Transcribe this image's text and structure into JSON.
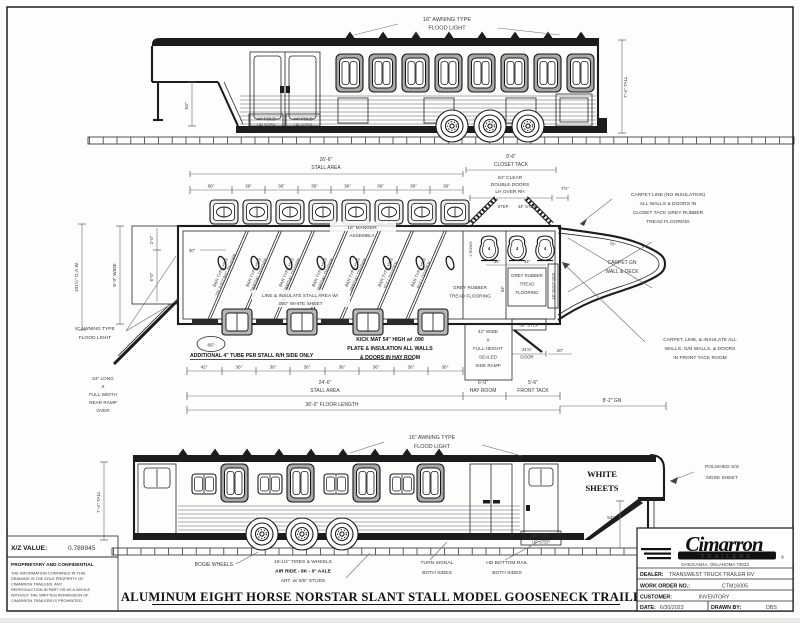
{
  "sheet": {
    "xz_label": "X/Z VALUE:",
    "xz_value": "0.788945",
    "confidential_title": "PROPRIETARY AND CONFIDENTIAL",
    "confidential_lines": [
      "THE INFORMATION CONTAINED IN THIS",
      "DRAWING IS THE SOLE PROPERTY OF",
      "CIMARRON TRAILERS.  ANY",
      "REPRODUCTION IN PART OR AS A WHOLE",
      "WITHOUT THE WRITTEN PERMISSION OF",
      "CIMARRON TRAILERS IS PROHIBITED."
    ],
    "main_title": "ALUMINUM EIGHT HORSE NORSTAR SLANT STALL MODEL GOOSENECK TRAILER"
  },
  "title_block": {
    "brand": "Cimarron",
    "brand_sub": "TRAILERS",
    "brand_reg": "®",
    "address": "CHICKASHA, OKLAHOMA 73023",
    "dealer_label": "DEALER:",
    "dealer_value": "TRANSWEST TRUCK TRAILER RV",
    "work_order_label": "WORK ORDER NO.:",
    "work_order_value": "CTM16005",
    "customer_label": "CUSTOMER:",
    "customer_value": "INVENTORY",
    "date_label": "DATE:",
    "date_value": "6/30/2023",
    "drawn_label": "DRAWN BY:",
    "drawn_value": "DBS"
  },
  "top_view": {
    "flood_light": [
      "16\" AWNING TYPE",
      "FLOOD LIGHT"
    ],
    "height": "7'-4\" TALL",
    "gn_drop": "53\"",
    "fold_step": [
      "44\" FOLD",
      "UP STEP"
    ]
  },
  "plan": {
    "stall_area_top": {
      "dim": "26'-6\"",
      "label": "STALL AREA"
    },
    "closet_tack": {
      "dim": "9'-6\"",
      "label": "CLOSET TACK"
    },
    "top_dims": [
      "66\"",
      "36\"",
      "36\"",
      "36\"",
      "36\"",
      "36\"",
      "36\"",
      "36\""
    ],
    "clear_doors": [
      "84\" CLEAR",
      "DOUBLE DOORS",
      "LH OVER RH"
    ],
    "dim_7_half": "7½\"",
    "manger": [
      "18\" MANGER",
      "ASSEMBLY"
    ],
    "oaw": "101½\" O.A.W.",
    "wide": "8'-0\" WIDE",
    "dim_2ft": "2'-0\"",
    "dim_30": "30\"",
    "dim_6ft": "6'-0\"",
    "awning": [
      "8\" AWNING TYPE",
      "FLOOD LIGHT"
    ],
    "rear_ramp": [
      "53\" LONG",
      "X",
      "FULL WIDTH",
      "REAR RAMP",
      "OVER"
    ],
    "balloon_66": "66\"",
    "added_tube": "ADDITIONAL 4\" TUBE PER STALL  R/H SIDE ONLY",
    "bottom_dims": [
      "42\"",
      "36\"",
      "36\"",
      "36\"",
      "36\"",
      "36\"",
      "36\"",
      "36\""
    ],
    "stall_area_bottom": {
      "dim": "24'-6\"",
      "label": "STALL AREA"
    },
    "floor_length": "36'-0\" FLOOR LENGTH",
    "hay_room": {
      "dim": "6'-0\"",
      "label": "HAY ROOM"
    },
    "front_tack": {
      "dim": "5'-6\"",
      "label": "FRONT TACK"
    },
    "gn_length": "8'-2\" GN",
    "line_insulate": [
      "LINE & INSULATE STALL AREA W/",
      ".050\" WHITE SHEET"
    ],
    "kick_mat": [
      "KICK MAT 54\" HIGH w/ .090",
      "PLATE & INSULATION ALL WALLS",
      "& DOORS IN HAY ROOM"
    ],
    "grey_rubber_hay": [
      "GREY RUBBER",
      "TREAD FLOORING"
    ],
    "grey_rubber_tack": [
      "GREY RUBBER",
      "TREAD",
      "FLOORING"
    ],
    "side_ramp": [
      "42\" WIDE",
      "X",
      "FULL HEIGHT",
      "SEALED",
      "SIDE RAMP"
    ],
    "dim_34a": "34\"",
    "dim_34b": "34\"",
    "dim_54": "54\"",
    "boot_box": "18\" BOOT BOX",
    "step_36": "36\" STEP",
    "step": "STEP",
    "step_44": "44\" STEP",
    "door_dim": "31¾\"",
    "door_label": "DOOR",
    "dim_20": "20\"",
    "dim_18": "18\"",
    "rows2": "2 ROWS",
    "saddle_count": "4",
    "carpet_closet": [
      "CARPET LINE (NO INSULATION)",
      "ALL WALLS & DOORS IN",
      "CLOSET TACK GREY RUBBER",
      "TREAD FLOORING"
    ],
    "carpet_gn": [
      "CARPET GN",
      "WALL & DECK"
    ],
    "carpet_front": [
      "CARPET, LINE, & INSULATE ALL",
      "WALLS, G/N WALLS, & DOORS",
      "IN FRONT TACK ROOM"
    ],
    "dividers": [
      {
        "l1": "BAR TYPE H&S",
        "l2": "TELESCOPIC DIVIDER"
      },
      {
        "l1": "BAR TYPE H&S",
        "l2": "PARTIAL DIVIDER"
      },
      {
        "l1": "BAR TYPE H&S",
        "l2": "PARTIAL DIVIDER"
      },
      {
        "l1": "BAR TYPE H&S",
        "l2": "PARTIAL DIVIDER"
      },
      {
        "l1": "BAR TYPE H&S",
        "l2": "PARTIAL DIVIDER"
      },
      {
        "l1": "BAR TYPE H&S",
        "l2": "FULL DIVIDER"
      },
      {
        "l1": "BAR TYPE H&S",
        "l2": "FULL DIVIDER"
      }
    ]
  },
  "bottom_view": {
    "flood_light": [
      "16\" AWNING TYPE",
      "FLOOD LIGHT"
    ],
    "height": "7'-4\" TALL",
    "white_sheets": [
      "WHITE",
      "SHEETS"
    ],
    "nose_sheet": [
      "POLISHED S/S",
      "NOSE SHEET"
    ],
    "gn_drop": "53\"",
    "fold_step": [
      "36\" FOLD",
      "UP STEP"
    ],
    "bogie": "BOGIE WHEELS",
    "tires": [
      "19-1/2\" TIRES & WHEELS",
      "AIR RIDE - 8K - 0\" AXLE",
      "ART. w/ 5/8\" STUDS"
    ],
    "turn_signal": [
      "TURN SIGNAL",
      "BOTH SIDES"
    ],
    "bottom_rail": [
      "HD BOTTOM RAIL",
      "BOTH SIDES"
    ]
  }
}
